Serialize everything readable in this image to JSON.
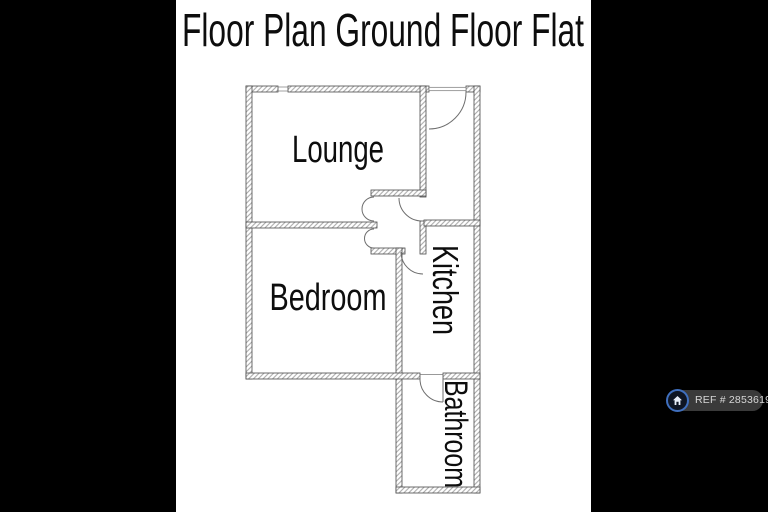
{
  "title": "Floor Plan Ground Floor Flat",
  "rooms": {
    "lounge": "Lounge",
    "bedroom": "Bedroom",
    "kitchen": "Kitchen",
    "bathroom": "Bathroom"
  },
  "watermark": {
    "ref": "REF # 2853619"
  },
  "colors": {
    "letterbox": "#000000",
    "paper": "#ffffff",
    "wall_hatch": "#9a9a9a",
    "wall_outline": "#4a4a4a",
    "door_line": "#6e6e6e",
    "label_text": "#0d0d0d",
    "watermark_pill": "#3a3a3a",
    "watermark_text": "#d6d6d6",
    "logo_ring": "#3f6fbe",
    "logo_background": "#0e1523",
    "logo_house": "#e8eef8"
  }
}
